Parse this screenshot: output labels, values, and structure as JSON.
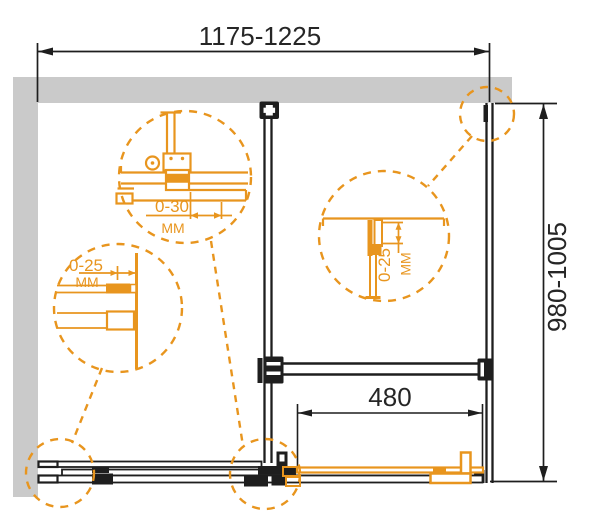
{
  "drawing": {
    "type": "shower-enclosure-installation-diagram",
    "dimensions": {
      "width_range": "1175-1225",
      "height_range": "980-1005",
      "door_opening_width": "480"
    },
    "details": {
      "top_roller": {
        "range": "0-30",
        "unit": "ММ"
      },
      "left_wall_profile": {
        "range": "0-25",
        "unit": "ММ"
      },
      "right_wall_profile": {
        "range": "0-25",
        "unit": "ММ"
      }
    },
    "colors": {
      "accent_orange": "#e8951e",
      "wall_gray": "#cacaca",
      "line_black": "#1e1e1e"
    }
  }
}
